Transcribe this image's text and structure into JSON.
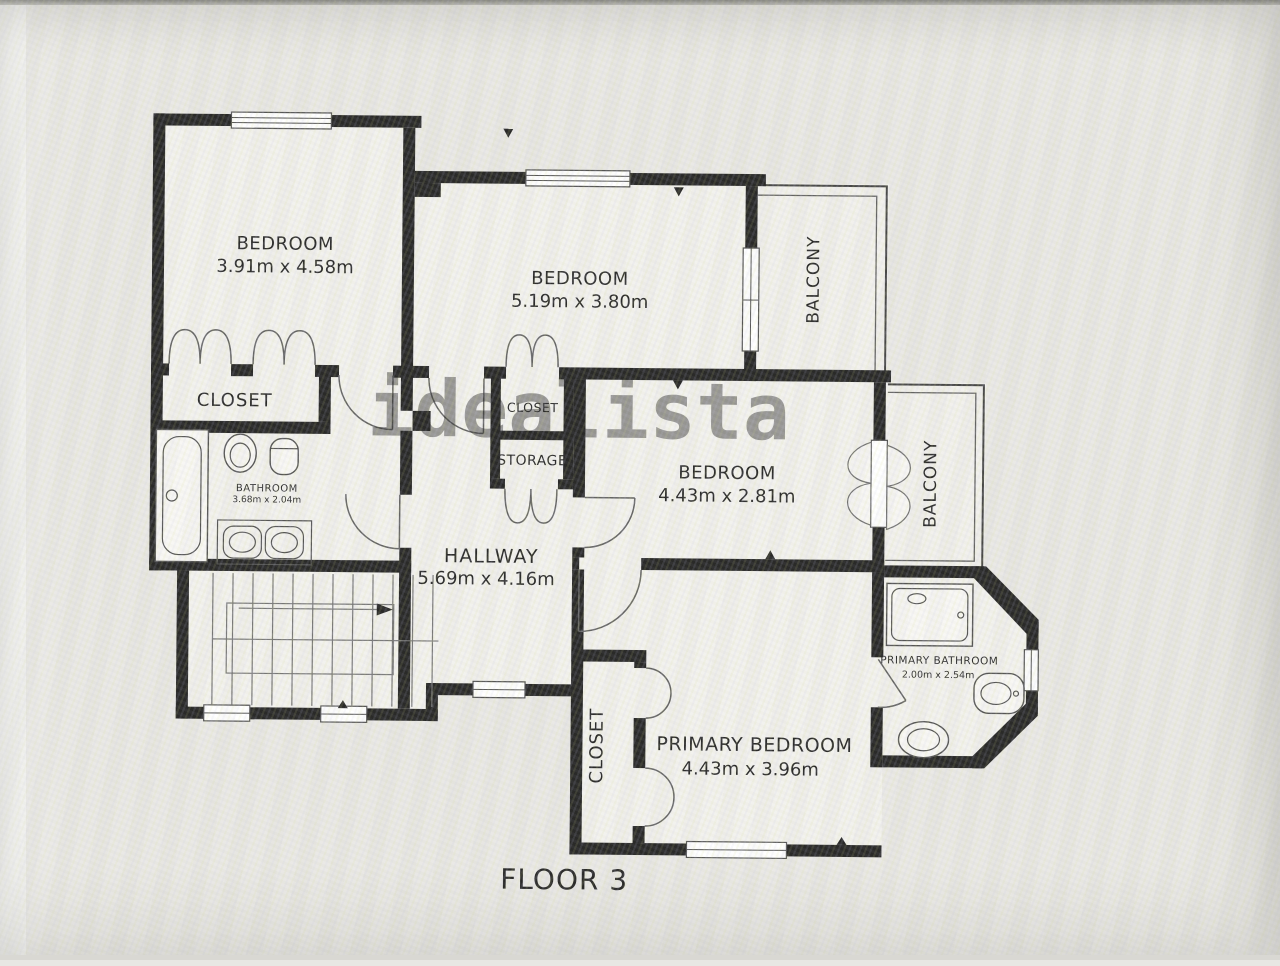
{
  "photo": {
    "floor_label": "FLOOR 3",
    "watermark": "idealista"
  },
  "rooms": {
    "bedroom1": {
      "label": "BEDROOM",
      "dims": "3.91m x 4.58m"
    },
    "bedroom2": {
      "label": "BEDROOM",
      "dims": "5.19m x 3.80m"
    },
    "bedroom3": {
      "label": "BEDROOM",
      "dims": "4.43m x 2.81m"
    },
    "primary_bedroom": {
      "label": "PRIMARY BEDROOM",
      "dims": "4.43m x 3.96m"
    },
    "hallway": {
      "label": "HALLWAY",
      "dims": "5.69m x 4.16m"
    },
    "bathroom": {
      "label": "BATHROOM",
      "dims": "3.68m x 2.04m"
    },
    "primary_bathroom": {
      "label": "PRIMARY BATHROOM",
      "dims": "2.00m x 2.54m"
    },
    "closet1": {
      "label": "CLOSET"
    },
    "closet2": {
      "label": "CLOSET"
    },
    "storage": {
      "label": "STORAGE"
    },
    "closet_primary": {
      "label": "CLOSET"
    },
    "balcony_top": {
      "label": "BALCONY"
    },
    "balcony_right": {
      "label": "BALCONY"
    }
  },
  "colors": {
    "wall": "#1b1b1b",
    "floor": "#f1f0ec",
    "background": "#e8e7e3",
    "fixture_line": "#4a4a4a",
    "watermark_gray": "#999999"
  }
}
